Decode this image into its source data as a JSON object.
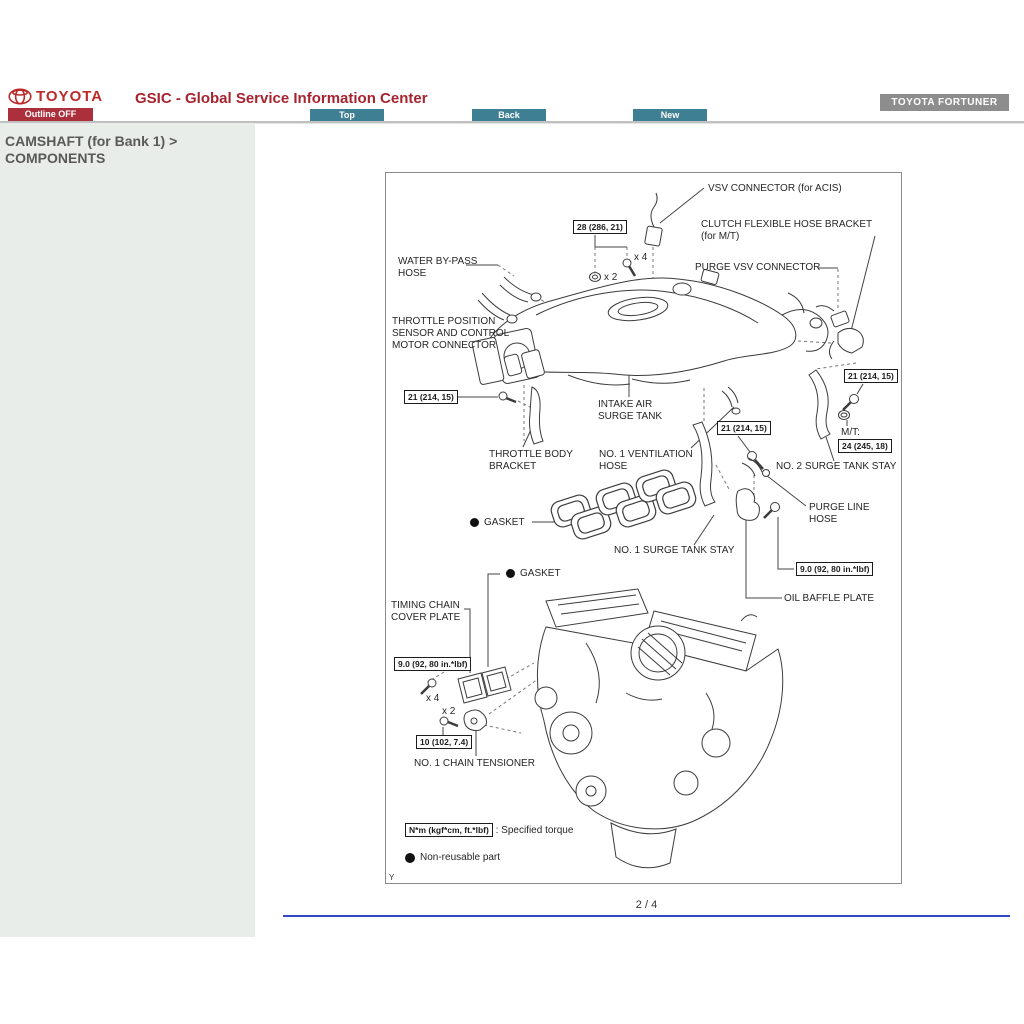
{
  "header": {
    "brand": "TOYOTA",
    "app_title": "GSIC - Global Service Information Center",
    "outline_button": "Outline OFF",
    "nav_top": "Top",
    "nav_back": "Back",
    "nav_new": "New",
    "vehicle_badge": "TOYOTA FORTUNER",
    "colors": {
      "brand_red": "#bb2b2b",
      "title_red": "#a62430",
      "button_red": "#ac2f3c",
      "nav_teal": "#3f7f93",
      "badge_gray": "#8d8d8d"
    }
  },
  "sidebar": {
    "heading_line1": "CAMSHAFT (for Bank 1) >",
    "heading_line2": "COMPONENTS",
    "background": "#e9ede9"
  },
  "diagram": {
    "corner_mark": "Y",
    "labels": {
      "vsv_connector": "VSV CONNECTOR (for ACIS)",
      "clutch_bracket_1": "CLUTCH FLEXIBLE HOSE BRACKET",
      "clutch_bracket_2": "(for M/T)",
      "water_bypass_1": "WATER BY-PASS",
      "water_bypass_2": "HOSE",
      "purge_vsv": "PURGE VSV CONNECTOR",
      "tps_1": "THROTTLE POSITION",
      "tps_2": "SENSOR AND CONTROL",
      "tps_3": "MOTOR CONNECTOR",
      "intake_1": "INTAKE AIR",
      "intake_2": "SURGE TANK",
      "throttle_bracket_1": "THROTTLE BODY",
      "throttle_bracket_2": "BRACKET",
      "vent_hose_1": "NO. 1 VENTILATION",
      "vent_hose_2": "HOSE",
      "no2_stay": "NO. 2 SURGE TANK STAY",
      "mt": "M/T:",
      "purge_line_1": "PURGE LINE",
      "purge_line_2": "HOSE",
      "gasket": "GASKET",
      "no1_stay": "NO. 1 SURGE TANK STAY",
      "oil_baffle": "OIL BAFFLE PLATE",
      "timing_cover_1": "TIMING CHAIN",
      "timing_cover_2": "COVER PLATE",
      "chain_tensioner": "NO. 1 CHAIN TENSIONER"
    },
    "torques": {
      "t28": "28 (286, 21)",
      "t21": "21 (214, 15)",
      "t24": "24 (245, 18)",
      "t9": "9.0 (92, 80 in.*lbf)",
      "t10": "10 (102, 7.4)"
    },
    "counts": {
      "x4": "x 4",
      "x2": "x 2"
    },
    "legend": {
      "torque_unit": "N*m (kgf*cm, ft.*lbf)",
      "torque_desc": ": Specified torque",
      "nonreusable": "Non-reusable part"
    }
  },
  "footer": {
    "page_indicator": "2 / 4",
    "rule_color": "#3747c0"
  }
}
